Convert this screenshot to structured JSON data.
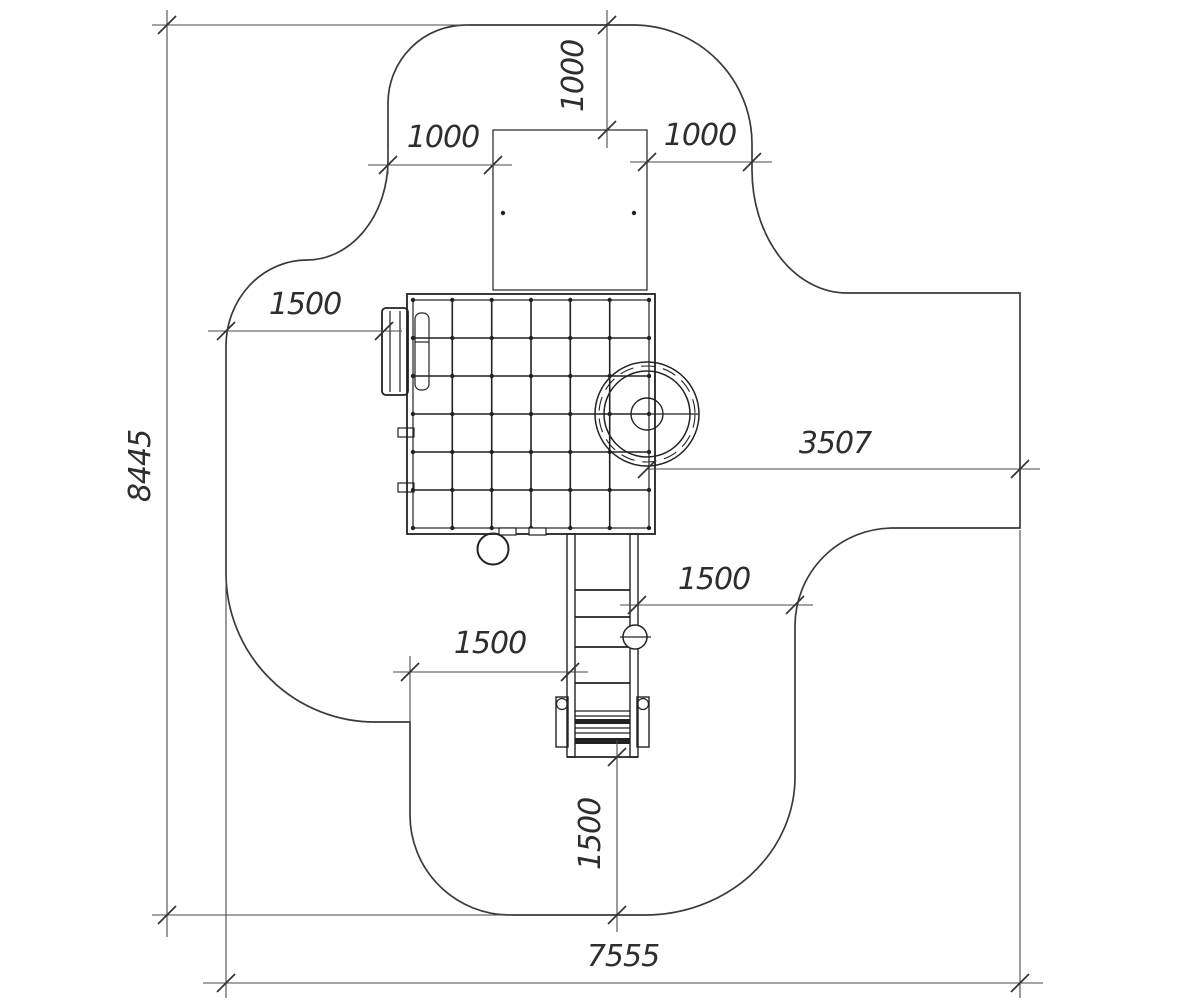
{
  "drawing": {
    "kind": "playground-equipment-safety-zone-plan",
    "background_color": "#ffffff",
    "outline_color": "#3a3a3a",
    "dimension_color": "#4a4a4a",
    "dims": {
      "overall_height": "8445",
      "overall_width": "7555",
      "top_offset_vertical": "1000",
      "top_offset_left": "1000",
      "top_offset_right": "1000",
      "left_offset": "1500",
      "right_offset": "3507",
      "ladder_right_offset": "1500",
      "ladder_left_offset": "1500",
      "bottom_offset": "1500"
    }
  }
}
